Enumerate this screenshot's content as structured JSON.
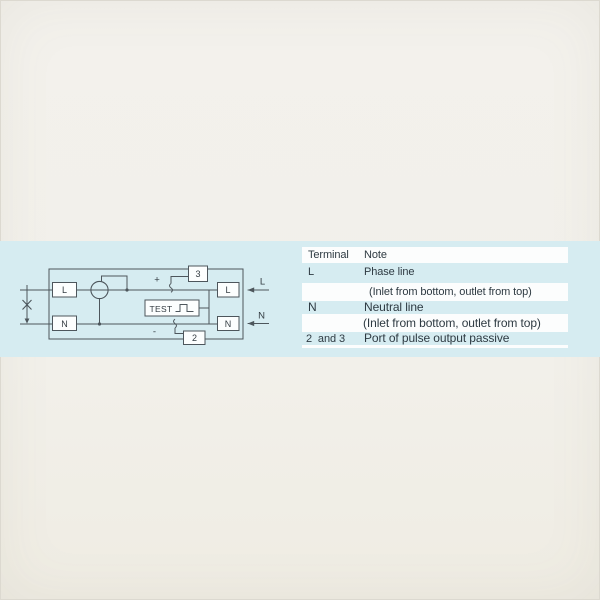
{
  "band_color": "#d6ecf1",
  "diagram": {
    "labels": {
      "left_l": "L",
      "left_n": "N",
      "right_l": "L",
      "right_n": "N",
      "box3": "3",
      "box2": "2",
      "test": "TEST",
      "plus": "+",
      "minus": "-",
      "arrow_l": "L",
      "arrow_n": "N"
    }
  },
  "table": {
    "header": {
      "terminal": "Terminal",
      "note": "Note"
    },
    "rows": [
      {
        "terminal": "L",
        "note": "Phase line"
      },
      {
        "terminal": "",
        "note": "(Inlet from bottom, outlet from top)"
      },
      {
        "terminal": "N",
        "note": "Neutral line"
      },
      {
        "terminal": "",
        "note": "(Inlet from bottom, outlet from top)"
      },
      {
        "terminal": "2  and 3",
        "note": "Port of pulse output passive"
      }
    ]
  }
}
